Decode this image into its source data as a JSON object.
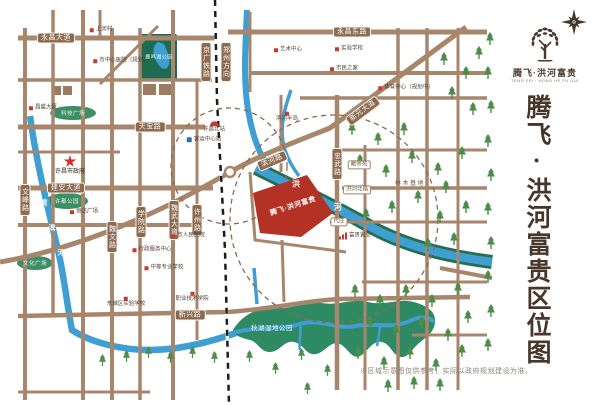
{
  "brand": {
    "title": "腾飞·洪河富贵",
    "tagline": "TENG FEI · HONG HE FU GUI"
  },
  "panel": {
    "vertical_title": "腾飞·洪河富贵区位图"
  },
  "footer": {
    "disclaimer": "※区域示意图仅供参考，实际以政府规划建设为准。"
  },
  "map": {
    "project_label": "腾飞·洪河富贵",
    "road_labels": [
      "永昌大道",
      "永昌东路",
      "天宝路",
      "建安大道",
      "新兴路",
      "新元大道",
      "滨河路",
      "文峰路",
      "魏文路",
      "学院路",
      "魏武大道",
      "许州路",
      "京广铁路",
      "郑州方向",
      "忠武路"
    ],
    "area_labels": [
      "献帝苑",
      "洪河北路",
      "代庄",
      "林木基地"
    ],
    "river_qingyi": [
      "清",
      "潩",
      "河"
    ],
    "river_honghe": [
      "洪",
      "河"
    ],
    "park_labels": [
      "鹿鸣湖公园",
      "科技广场",
      "许都公园",
      "文化广场",
      "秋湖湿地公园"
    ],
    "landmarks": [
      "上河村",
      "市中心医院（规划）",
      "昌盛大厦",
      "艺术中心",
      "实验学校",
      "市民之家",
      "体育中心（规划中）",
      "滨河半岛",
      "许昌北站",
      "客运中心站",
      "恒达广场",
      "行政服务中心",
      "市人民医院",
      "中等专业学校",
      "东城区实验学校",
      "职业技术学院",
      "富贵置业",
      "许昌市政府"
    ],
    "colors": {
      "road": "#a7866c",
      "road_pill": "#8c6a50",
      "river": "#3f9fd2",
      "river_bank": "#256f4d",
      "park": "#3c8e66",
      "park_dark": "#1e6b50",
      "wetland": "#2e8a63",
      "project_red": "#b33125",
      "landmark_red": "#c23b2e",
      "tree_green": "#4e8c49",
      "title_brown": "#47362a"
    }
  }
}
